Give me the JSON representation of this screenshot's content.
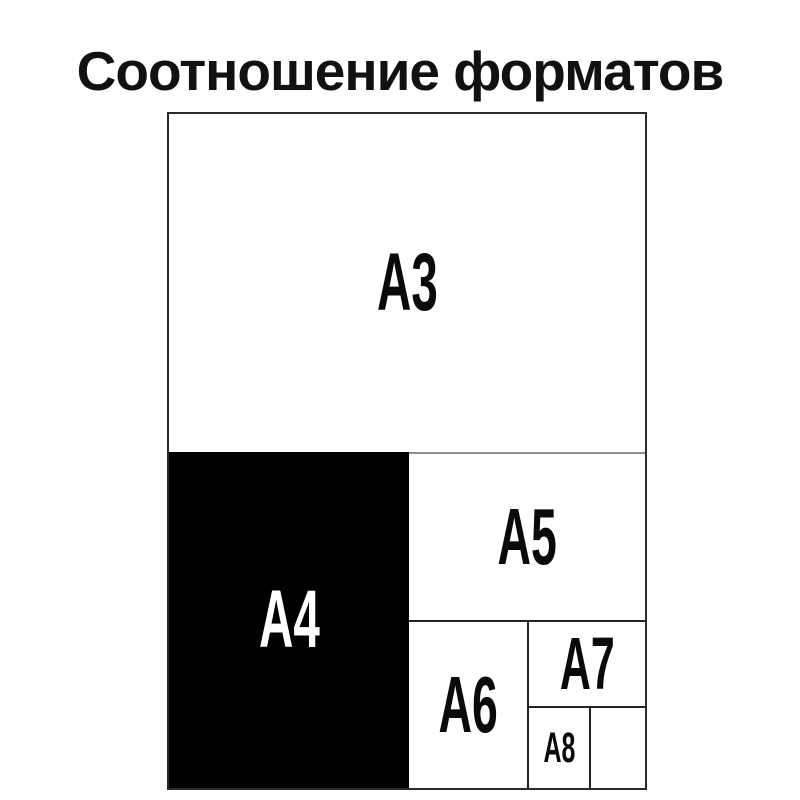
{
  "title": "Соотношение форматов",
  "diagram": {
    "description": "Nested comparison of ISO A-series paper formats",
    "formats": [
      {
        "id": "a3",
        "label": "A3"
      },
      {
        "id": "a4",
        "label": "A4"
      },
      {
        "id": "a5",
        "label": "A5"
      },
      {
        "id": "a6",
        "label": "A6"
      },
      {
        "id": "a7",
        "label": "A7"
      },
      {
        "id": "a8",
        "label": "A8"
      }
    ],
    "colors": {
      "background": "#ffffff",
      "outer_border": "#2b2b2b",
      "divider_dark": "#222222",
      "divider_gray": "#8f8f8f",
      "a4_fill": "#000000",
      "label_dark": "#0a0a0a",
      "label_light": "#ffffff",
      "title_color": "#111111"
    }
  }
}
